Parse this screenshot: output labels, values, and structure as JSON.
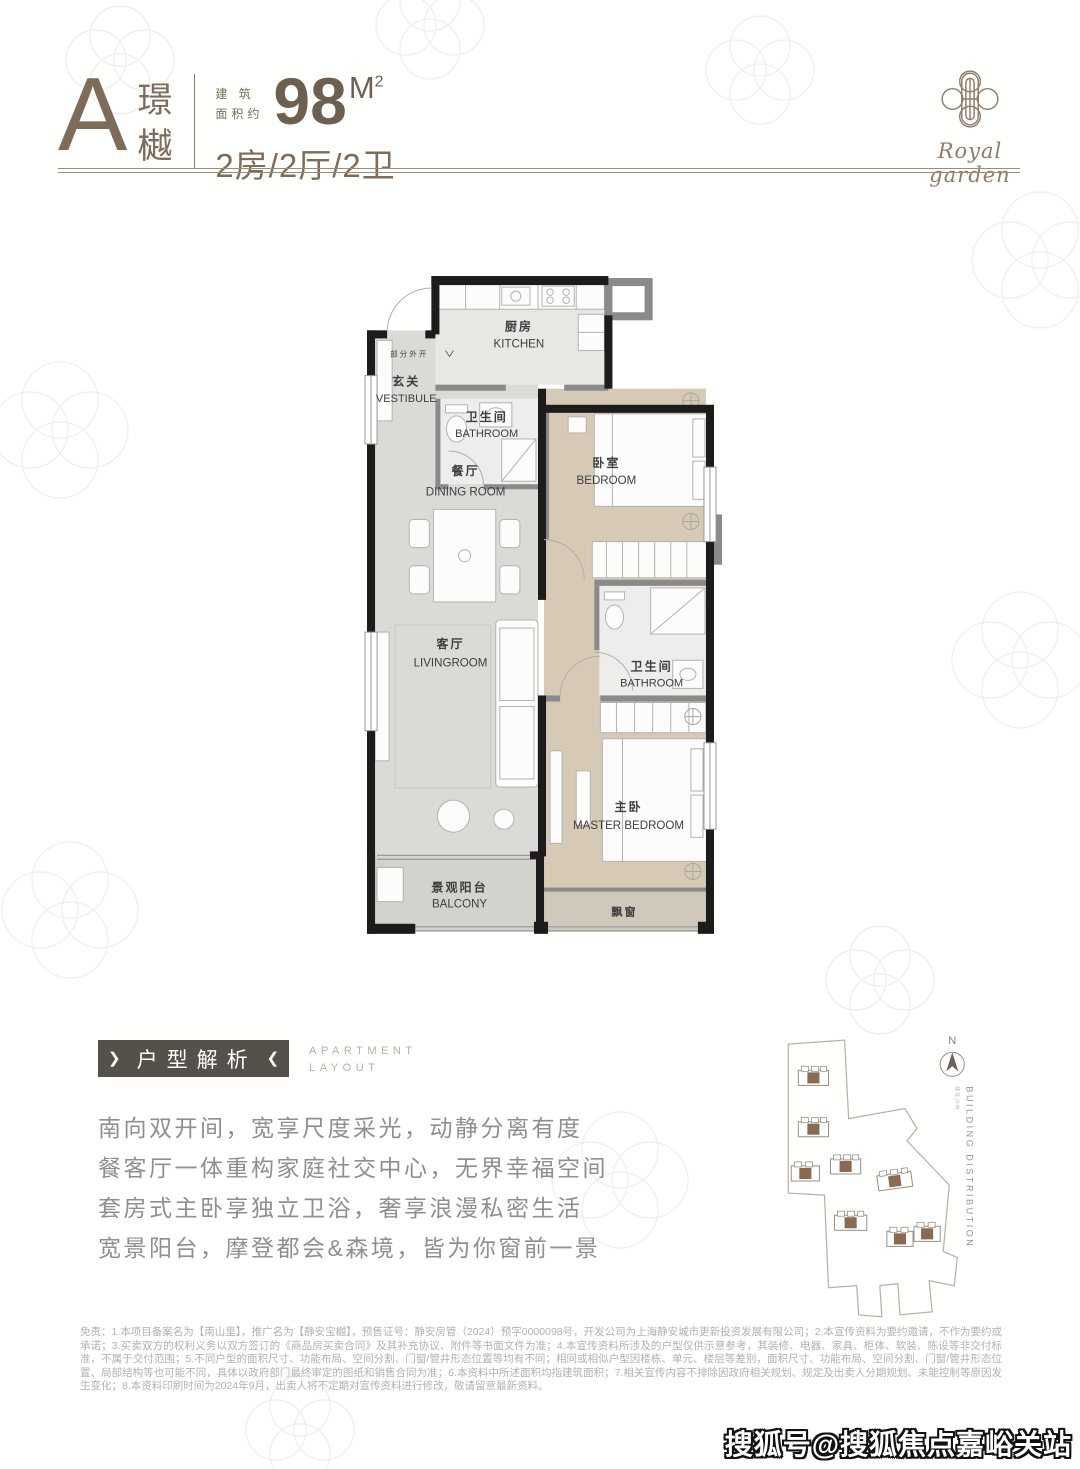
{
  "header": {
    "type_letter": "A",
    "name_char_1": "璟",
    "name_char_2": "樾",
    "area_label_line1": "建 筑",
    "area_label_line2": "面积约",
    "area_value": "98",
    "area_unit": "M",
    "area_unit_exp": "2",
    "layout_spec": "2房/2厅/2卫"
  },
  "logo": {
    "brand_script": "Royal garden"
  },
  "floorplan": {
    "door_note": "部分外开",
    "rooms": {
      "kitchen": {
        "zh": "厨房",
        "en": "KITCHEN"
      },
      "vestibule": {
        "zh": "玄关",
        "en": "VESTIBULE"
      },
      "bathroom_1": {
        "zh": "卫生间",
        "en": "BATHROOM"
      },
      "dining": {
        "zh": "餐厅",
        "en": "DINING ROOM"
      },
      "bedroom": {
        "zh": "卧室",
        "en": "BEDROOM"
      },
      "bathroom_2": {
        "zh": "卫生间",
        "en": "BATHROOM"
      },
      "living": {
        "zh": "客厅",
        "en": "LIVINGROOM"
      },
      "master_bedroom": {
        "zh": "主卧",
        "en": "MASTER BEDROOM"
      },
      "balcony": {
        "zh": "景观阳台",
        "en": "BALCONY"
      },
      "bay_window": {
        "zh": "飘窗"
      }
    }
  },
  "analysis": {
    "badge": "户型解析",
    "badge_chevron_left": "❯",
    "badge_chevron_right": "❮",
    "badge_en_line1": "APARTMENT",
    "badge_en_line2": "LAYOUT",
    "lines": [
      "南向双开间，宽享尺度采光，动静分离有度",
      "餐客厅一体重构家庭社交中心，无界幸福空间",
      "套房式主卧享独立卫浴，奢享浪漫私密生活",
      "宽景阳台，摩登都会&森境，皆为你窗前一景"
    ]
  },
  "siteplan": {
    "north": "N",
    "caption": "BUILDING DISTRIBUTION",
    "caption_zh": "楼栋分布"
  },
  "disclaimer": "免责：1.本项目备案名为【南山里】，推广名为【静安宝樾】，预售证号：静安房管（2024）预字0000098号，开发公司为上海静安城市更新投资发展有限公司；2.本宣传资料为要约邀请，不作为要约或承诺；3.买卖双方的权利义务以双方签订的《商品房买卖合同》及其补充协议、附件等书面文件为准；4.本宣传资料所涉及的户型仅供示意参考，其装修、电器、家具、柜体、软装、陈设等非交付标准，不属于交付范围；5.不同户型的面积尺寸、功能布局、空间分割、门窗/管井形态位置等均有不同；相同或相似户型因楼栋、单元、楼层等差别，面积尺寸、功能布局、空间分割、门窗/管井形态位置、局部结构等也可能不同，具体以政府部门最终审定的图纸和销售合同为准；6.本资料中所述面积均指建筑面积；7.相关宣传内容不排除因政府相关规划、规定及出卖人分期规划、未能控制等原因发生变化；8.本资料印刷时间为2024年9月，出卖人将不定期对宣传资料进行修改，敬请留意最新资料。",
  "watermark": "搜狐号@搜狐焦点嘉峪关站",
  "colors": {
    "accent_brown": "#7c6c59",
    "badge_brown": "#56504a",
    "wall_black": "#1c1c1c",
    "wall_gray": "#8a8a8a",
    "floor_gray": "#dbdad6",
    "floor_beige": "#d6cab6",
    "desc_gray": "#8f8f8f"
  }
}
